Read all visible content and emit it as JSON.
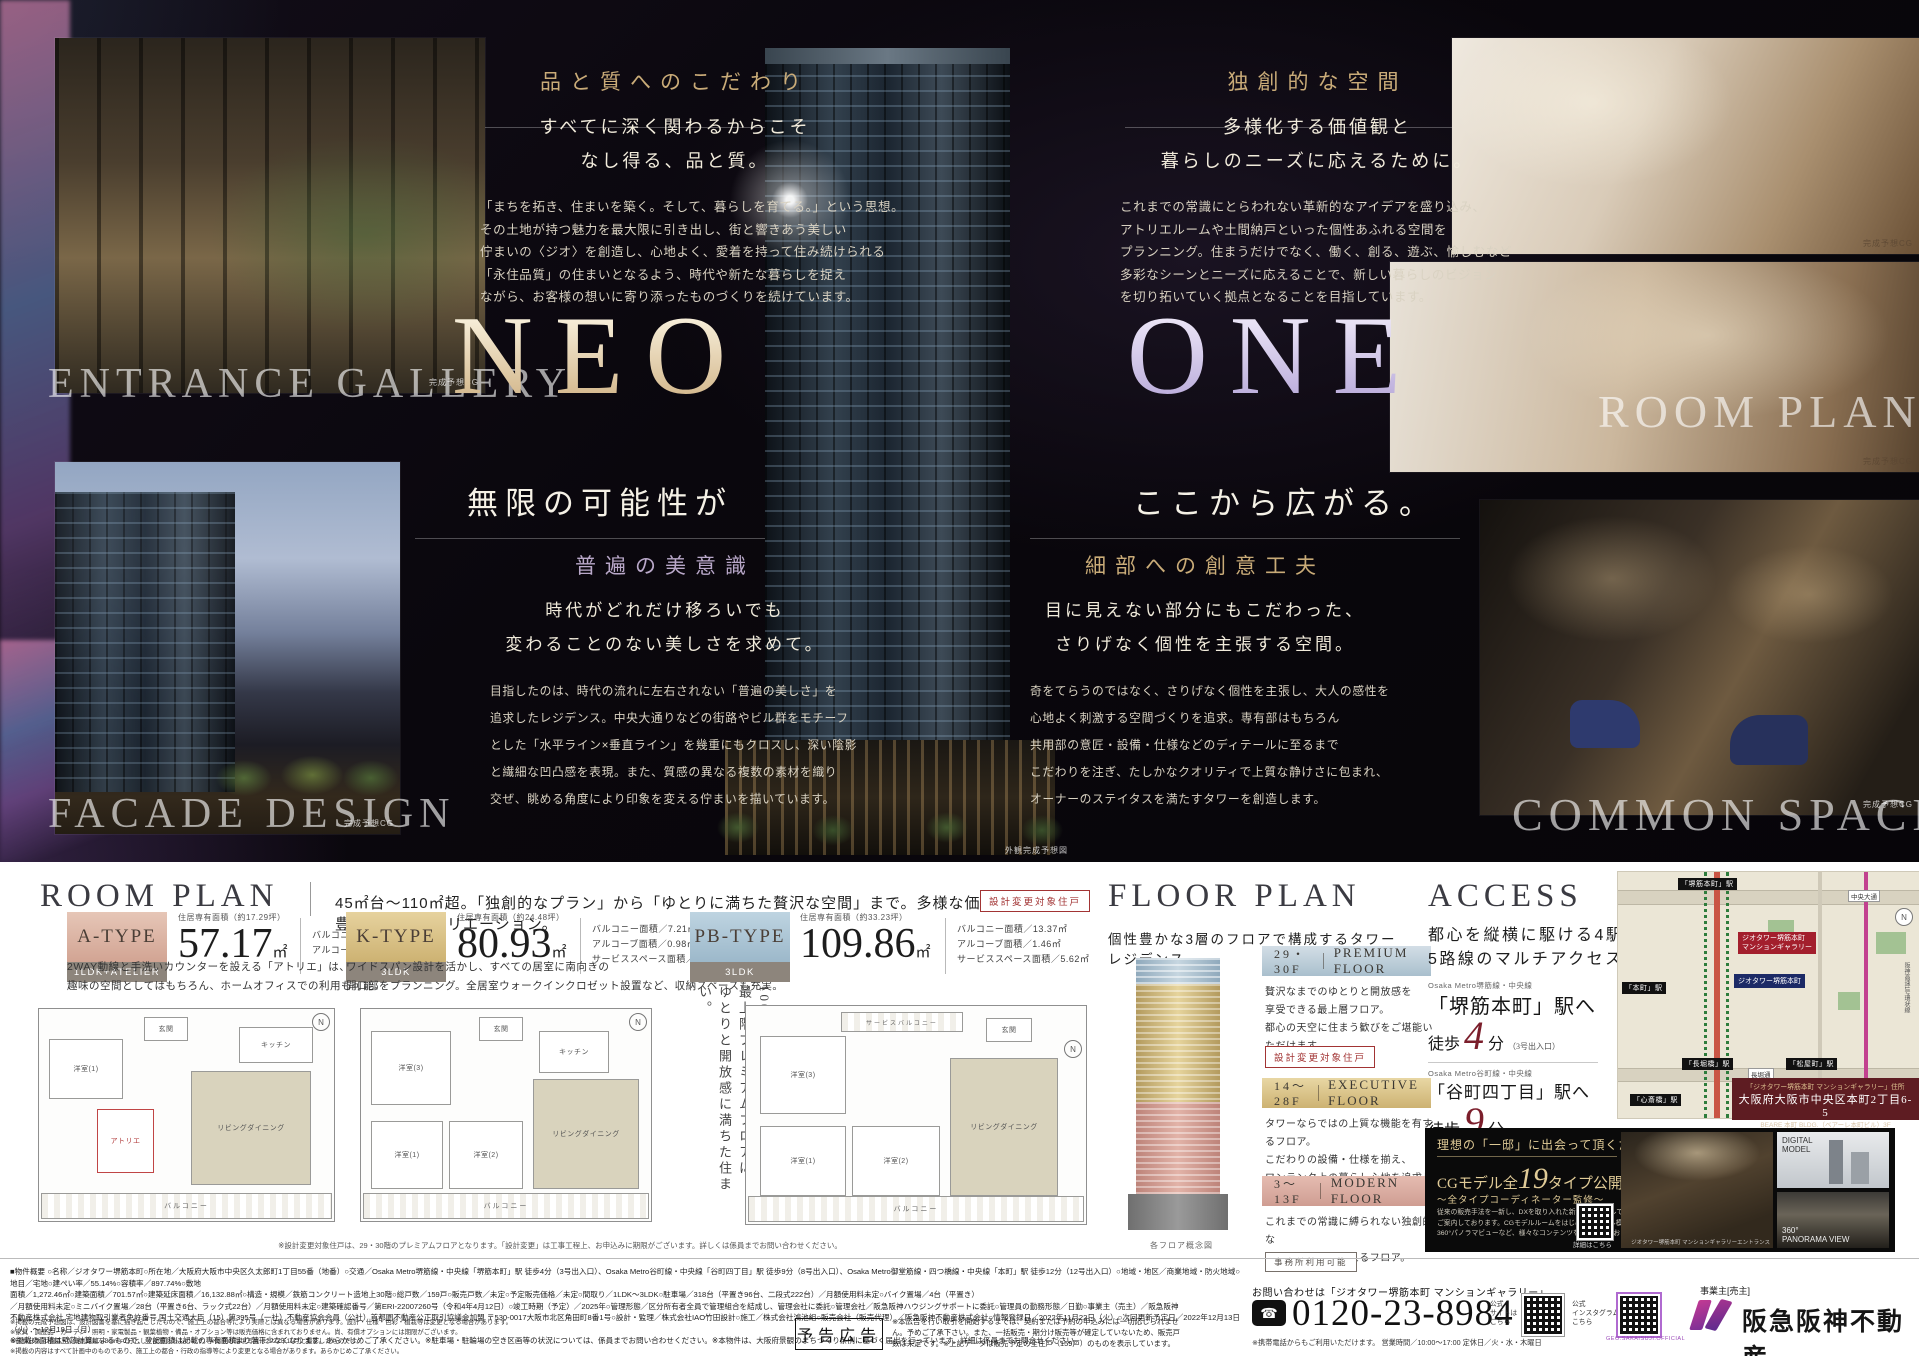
{
  "colors": {
    "gold": "#c5a572",
    "dark_red": "#7b1e2b",
    "premium_blue": "#b7c9d6",
    "executive_gold": "#d7bd85",
    "modern_pink": "#d9a89d",
    "brand_purple": "#9b308c",
    "map_red": "#a31f2d",
    "navy": "#1c2a66"
  },
  "hero": {
    "brand": {
      "neo": "NEO",
      "one": "ONE",
      "tag_left": "無限の可能性が",
      "tag_right": "ここから広がる。"
    },
    "quality": {
      "title": "品と質へのこだわり",
      "lead1": "すべてに深く関わるからこそ",
      "lead2": "なし得る、品と質。",
      "b1": "「まちを拓き、住まいを築く。そして、暮らしを育てる。」という思想。",
      "b2": "その土地が持つ魅力を最大限に引き出し、街と響きあう美しい",
      "b3": "佇まいの〈ジオ〉を創造し、心地よく、愛着を持って住み続けられる",
      "b4": "「永住品質」の住まいとなるよう、時代や新たな暮らしを捉え",
      "b5": "ながら、お客様の想いに寄り添ったものづくりを続けています。"
    },
    "original": {
      "title": "独創的な空間",
      "lead1": "多様化する価値観と",
      "lead2": "暮らしのニーズに応えるために。",
      "b1": "これまでの常識にとらわれない革新的なアイデアを盛り込み、",
      "b2": "アトリエルームや土間納戸といった個性あふれる空間を",
      "b3": "プランニング。住まうだけでなく、働く、創る、遊ぶ、愉しむなど",
      "b4": "多彩なシーンとニーズに応えることで、新しい暮らしのビジョン",
      "b5": "を切り拓いていく拠点となることを目指しています。"
    },
    "beauty": {
      "title": "普遍の美意識",
      "lead1": "時代がどれだけ移ろいでも",
      "lead2": "変わることのない美しさを求めて。",
      "b1": "目指したのは、時代の流れに左右されない「普遍の美しさ」を",
      "b2": "追求したレジデンス。中央大通りなどの街路やビル群をモチーフ",
      "b3": "とした「水平ライン×垂直ライン」を幾重にもクロスし、深い陰影",
      "b4": "と繊細な凹凸感を表現。また、質感の異なる複数の素材を織り",
      "b5": "交ぜ、眺める角度により印象を変える佇まいを描いています。"
    },
    "detail": {
      "title": "細部への創意工夫",
      "lead1": "目に見えない部分にもこだわった、",
      "lead2": "さりげなく個性を主張する空間。",
      "b1": "奇をてらうのではなく、さりげなく個性を主張し、大人の感性を",
      "b2": "心地よく刺激する空間づくりを追求。専有部はもちろん",
      "b3": "共用部の意匠・設備・仕様などのディテールに至るまで",
      "b4": "こだわりを注ぎ、たしかなクオリティで上質な静けさに包まれ、",
      "b5": "オーナーのステイタスを満たすタワーを創造します。"
    },
    "overlay_entrance": "ENTRANCE GALLERY",
    "overlay_facade": "FACADE DESIGN",
    "overlay_room": "ROOM PLAN",
    "overlay_common": "COMMON SPACE",
    "caption_tower": "外観完成予想図",
    "caption_cg": "完成予想CG"
  },
  "room_plan": {
    "title": "ROOM PLAN",
    "lead": "45㎡台〜110㎡超。「独創的なプラン」から「ゆとりに満ちた贅沢な空間」まで。多様な価値観に応える、豊富なプランバリエーション。",
    "types": [
      {
        "name": "A-TYPE",
        "layout": "1LDK+ATELIER",
        "area_label": "住居専有面積（約17.29坪）",
        "area": "57.17",
        "unit": "㎡",
        "d1": "バルコニー面積／6.51㎡",
        "d2": "アルコーブ面積／1.41㎡",
        "d3": "",
        "desc1": "2WAY動線と手洗いカウンターを設える「アトリエ」は、",
        "desc2": "趣味の空間としてはもちろん、ホームオフィスでの利用も可能。"
      },
      {
        "name": "K-TYPE",
        "layout": "3LDK",
        "area_label": "住居専有面積（約24.48坪）",
        "area": "80.93",
        "unit": "㎡",
        "d1": "バルコニー面積／7.21㎡",
        "d2": "アルコーブ面積／0.98㎡",
        "d3": "サービススペース面積／1.56㎡",
        "desc1": "ワイドスパン設計を活かし、すべての居室に南向きの",
        "desc2": "開口部をプランニング。全居室ウォークインクロゼット設置など、収納スペースも充実。"
      },
      {
        "name": "PB-TYPE",
        "layout": "3LDK",
        "area_label": "住居専有面積（約33.23坪）",
        "area": "109.86",
        "unit": "㎡",
        "d1": "バルコニー面積／13.37㎡",
        "d2": "アルコーブ面積／1.46㎡",
        "d3": "サービススペース面積／5.62㎡",
        "badge": "設計変更対象住戸",
        "v1": "100㎡超の悠々たる広さを、",
        "v2": "最上階プレミアムフロアに。",
        "v3": "ゆとりと開放感に満ちた住まい。"
      }
    ],
    "rooms": {
      "ld": "リビングダイニング",
      "atelier": "アトリエ",
      "west1": "洋室(1)",
      "west2": "洋室(2)",
      "west3": "洋室(3)",
      "kitchen": "キッチン",
      "balcony": "バルコニー",
      "service": "サービスバルコニー",
      "entrance": "玄関"
    },
    "note": "※設計変更対象住戸は、29・30階のプレミアムフロアとなります。「設計変更」は工事工程上、お申込みに期限がございます。詳しくは係員までお問い合わせください。"
  },
  "floor_plan": {
    "title": "FLOOR PLAN",
    "lead": "個性豊かな3層のフロアで構成するタワーレジデンス。",
    "floors": [
      {
        "range": "29・30F",
        "name": "PREMIUM FLOOR",
        "l1": "贅沢なまでのゆとりと開放感を",
        "l2": "享受できる最上層フロア。",
        "l3": "都心の天空に住まう歓びをご堪能いただけます。",
        "badge": "設計変更対象住戸"
      },
      {
        "range": "14〜28F",
        "name": "EXECUTIVE FLOOR",
        "l1": "タワーならではの上質な機能を有するフロア。",
        "l2": "こだわりの設備・仕様を揃え、",
        "l3": "ワンランク上の暮らし心地を追求しています。",
        "badge": ""
      },
      {
        "range": "3〜13F",
        "name": "MODERN FLOOR",
        "l1": "これまでの常識に縛られない独創的な",
        "l2": "プランニングを設えるフロア。",
        "l3": "自分らしいライフスタイルをサポートします。",
        "badge": "事務所利用可能"
      }
    ],
    "caption": "各フロア概念図"
  },
  "access": {
    "title": "ACCESS",
    "lead1": "都心を縦横に駆ける4駅",
    "lead2": "5路線のマルチアクセス。",
    "stations": [
      {
        "line": "Osaka Metro堺筋線・中央線",
        "name": "「堺筋本町」駅へ",
        "walk": "徒歩",
        "min": "4",
        "unit": "分",
        "exit": "（3号出入口）"
      },
      {
        "line": "Osaka Metro谷町線・中央線",
        "name": "「谷町四丁目」駅へ",
        "walk": "徒歩",
        "min": "9",
        "unit": "分",
        "exit": "（8号出入口）"
      },
      {
        "line": "Osaka Metro御堂筋線・四つ橋線・中央線",
        "name": "「本町」駅へ",
        "walk": "徒歩",
        "min": "12",
        "unit": "分",
        "exit": "（12号出入口）"
      }
    ],
    "map": {
      "gallery1": "ジオタワー堺筋本町",
      "gallery2": "マンションギャラリー",
      "property": "ジオタワー堺筋本町",
      "sta_sakaisuji": "「堺筋本町」駅",
      "sta_hommachi": "「本町」駅",
      "sta_nagahoribashi": "「長堀橋」駅",
      "sta_matsuyamachi": "「松屋町」駅",
      "sta_shinsaibashi": "「心斎橋」駅",
      "road_nagahori": "長堀通",
      "road_chuo": "中央大通",
      "highway": "阪神高速1号環状線",
      "compass": "N"
    },
    "address": {
      "heading": "「ジオタワー堺筋本町 マンションギャラリー」住所",
      "line1": "大阪府大阪市中央区本町2丁目6-5",
      "line2": "BEARE 本町 BLDG.（ベアーレ本町ビル）3F"
    }
  },
  "cg": {
    "heading": "理想の「一邸」に出会って頂くために。",
    "title_pre": "CGモデル全",
    "title_num": "19",
    "title_post": "タイプ公開中",
    "subtitle": "〜全タイプコーディネーター監修〜",
    "b1": "従来の販売手法を一新し、DXを取り入れた新たなスタイルで",
    "b2": "ご案内しております。CGモデルルームをはじめ、デジタル模型・",
    "b3": "360°パノラマビューなど、様々なコンテンツをご用意しております。",
    "qr_caption": "詳細はこちら",
    "photo_caption": "ジオタワー堺筋本町 マンションギャラリーエントランス",
    "thumb1a": "DIGITAL",
    "thumb1b": "MODEL",
    "thumb2a": "360°",
    "thumb2b": "PANORAMA VIEW"
  },
  "footer": {
    "outline": [
      "■物件概要 ○名称／ジオタワー堺筋本町○所在地／大阪府大阪市中央区久太郎町1丁目55番（地番）○交通／Osaka Metro堺筋線・中央線「堺筋本町」駅 徒歩4分（3号出入口）、Osaka Metro谷町線・中央線「谷町四丁目」駅 徒歩9分（8号出入口）、Osaka Metro御堂筋線・四つ橋線・中央線「本町」駅 徒歩12分（12号出入口）○地域・地区／商業地域・防火地域○地目／宅地○建ぺい率／55.14%○容積率／897.74%○敷地",
      "面積／1,272.46㎡○建築面積／701.57㎡○建築延床面積／16,132.88㎡○構造・規模／鉄筋コンクリート造地上30階○総戸数／159戸○販売戸数／未定○予定販売価格／未定○間取り／1LDK〜3LDK○駐車場／318台（平置き96台、二段式222台）／月額使用料未定○バイク置場／4台（平置き）",
      "／月額使用料未定○ミニバイク置場／28台（平置き6台、ラック式22台）／月額使用料未定○建築確認番号／第ERI-22007260号（令和4年4月12日）○竣工時期（予定）／2025年○管理形態／区分所有者全員で管理組合を結成し、管理会社に委託○管理会社／阪急阪神ハウジングサポートに委託○管理員の勤務形態／日勤○事業主（売主）／阪急阪神",
      "不動産株式会社 宅地建物取引業者免許番号 国土交通大臣（15）第395号（一社）不動産協会会員（公社）首都圏不動産公正取引協議会加盟 〒530-0017大阪市北区角田町8番1号○設計・監理／株式会社IAO竹田設計○施工／株式会社鴻池組○販売会社（販売代理）／阪急阪神不動産株式会社○情報登録日／2022年11月22日（火）○次回更新予定日／2022年12月13日（火）〜12月19日（月）",
      "※掲載の面積は壁芯計算によるもので、登記面積は記載の専有面積より若干少なくなります。あらかじめご了承ください。※駐車場・駐輪場の空き区画等の状況については、係員までお問い合わせください。※本物件は、大阪府景観のまちづくり条例に基づく届出を行っています。詳細は係員までお問合せください。"
    ],
    "notes": [
      "※掲載の完成予想図は、設計図書を基に描き起こしたもので、施工上の都合等により実際とは異なる場合があります。設計・仕様・色彩・植栽等は変更となる場合があります。",
      "※家具・調度品・カーテン・照明・家電製品・観葉植物・備品・オプション等は販売価格に含まれておりません。尚、有償オプションには期限がございます。",
      "※徒歩分数は地図上の概測距離を80m＝1分として換算したものです。※掲載の環境写真は2022年11月に撮影したものです。",
      "※掲載の内容はすべて計画中のものであり、施工上の都合・行政の指導等により変更となる場合があります。あらかじめご了承ください。"
    ],
    "yokoku": "予告広告",
    "yokoku_note": [
      "※本広告を行い取引を開始するまでは、契約または予約の申込みには一切応じられませ",
      "ん。予めご了承下さい。また、一括販売・期分け販売等が確定していないため、販売戸",
      "数は未定です。※上記データは販売予定の全住戸（159戸）のものを表示しています。"
    ],
    "contact_heading": "お問い合わせは「ジオタワー堺筋本町 マンションギャラリー」",
    "phone": "0120-23-8984",
    "phone_note": "※携帯電話からもご利用いただけます。 営業時間／10:00〜17:00 定休日／火・水・木曜日",
    "qr1a": "公式",
    "qr1b": "サイトは",
    "qr1c": "こちら",
    "qr2a": "公式",
    "qr2b": "インスタグラムは",
    "qr2c": "こちら",
    "insta_id": "GEO.SAKAISUJI.OFFICIAL",
    "company_role": "事業主[売主]",
    "company": "阪急阪神不動産"
  }
}
